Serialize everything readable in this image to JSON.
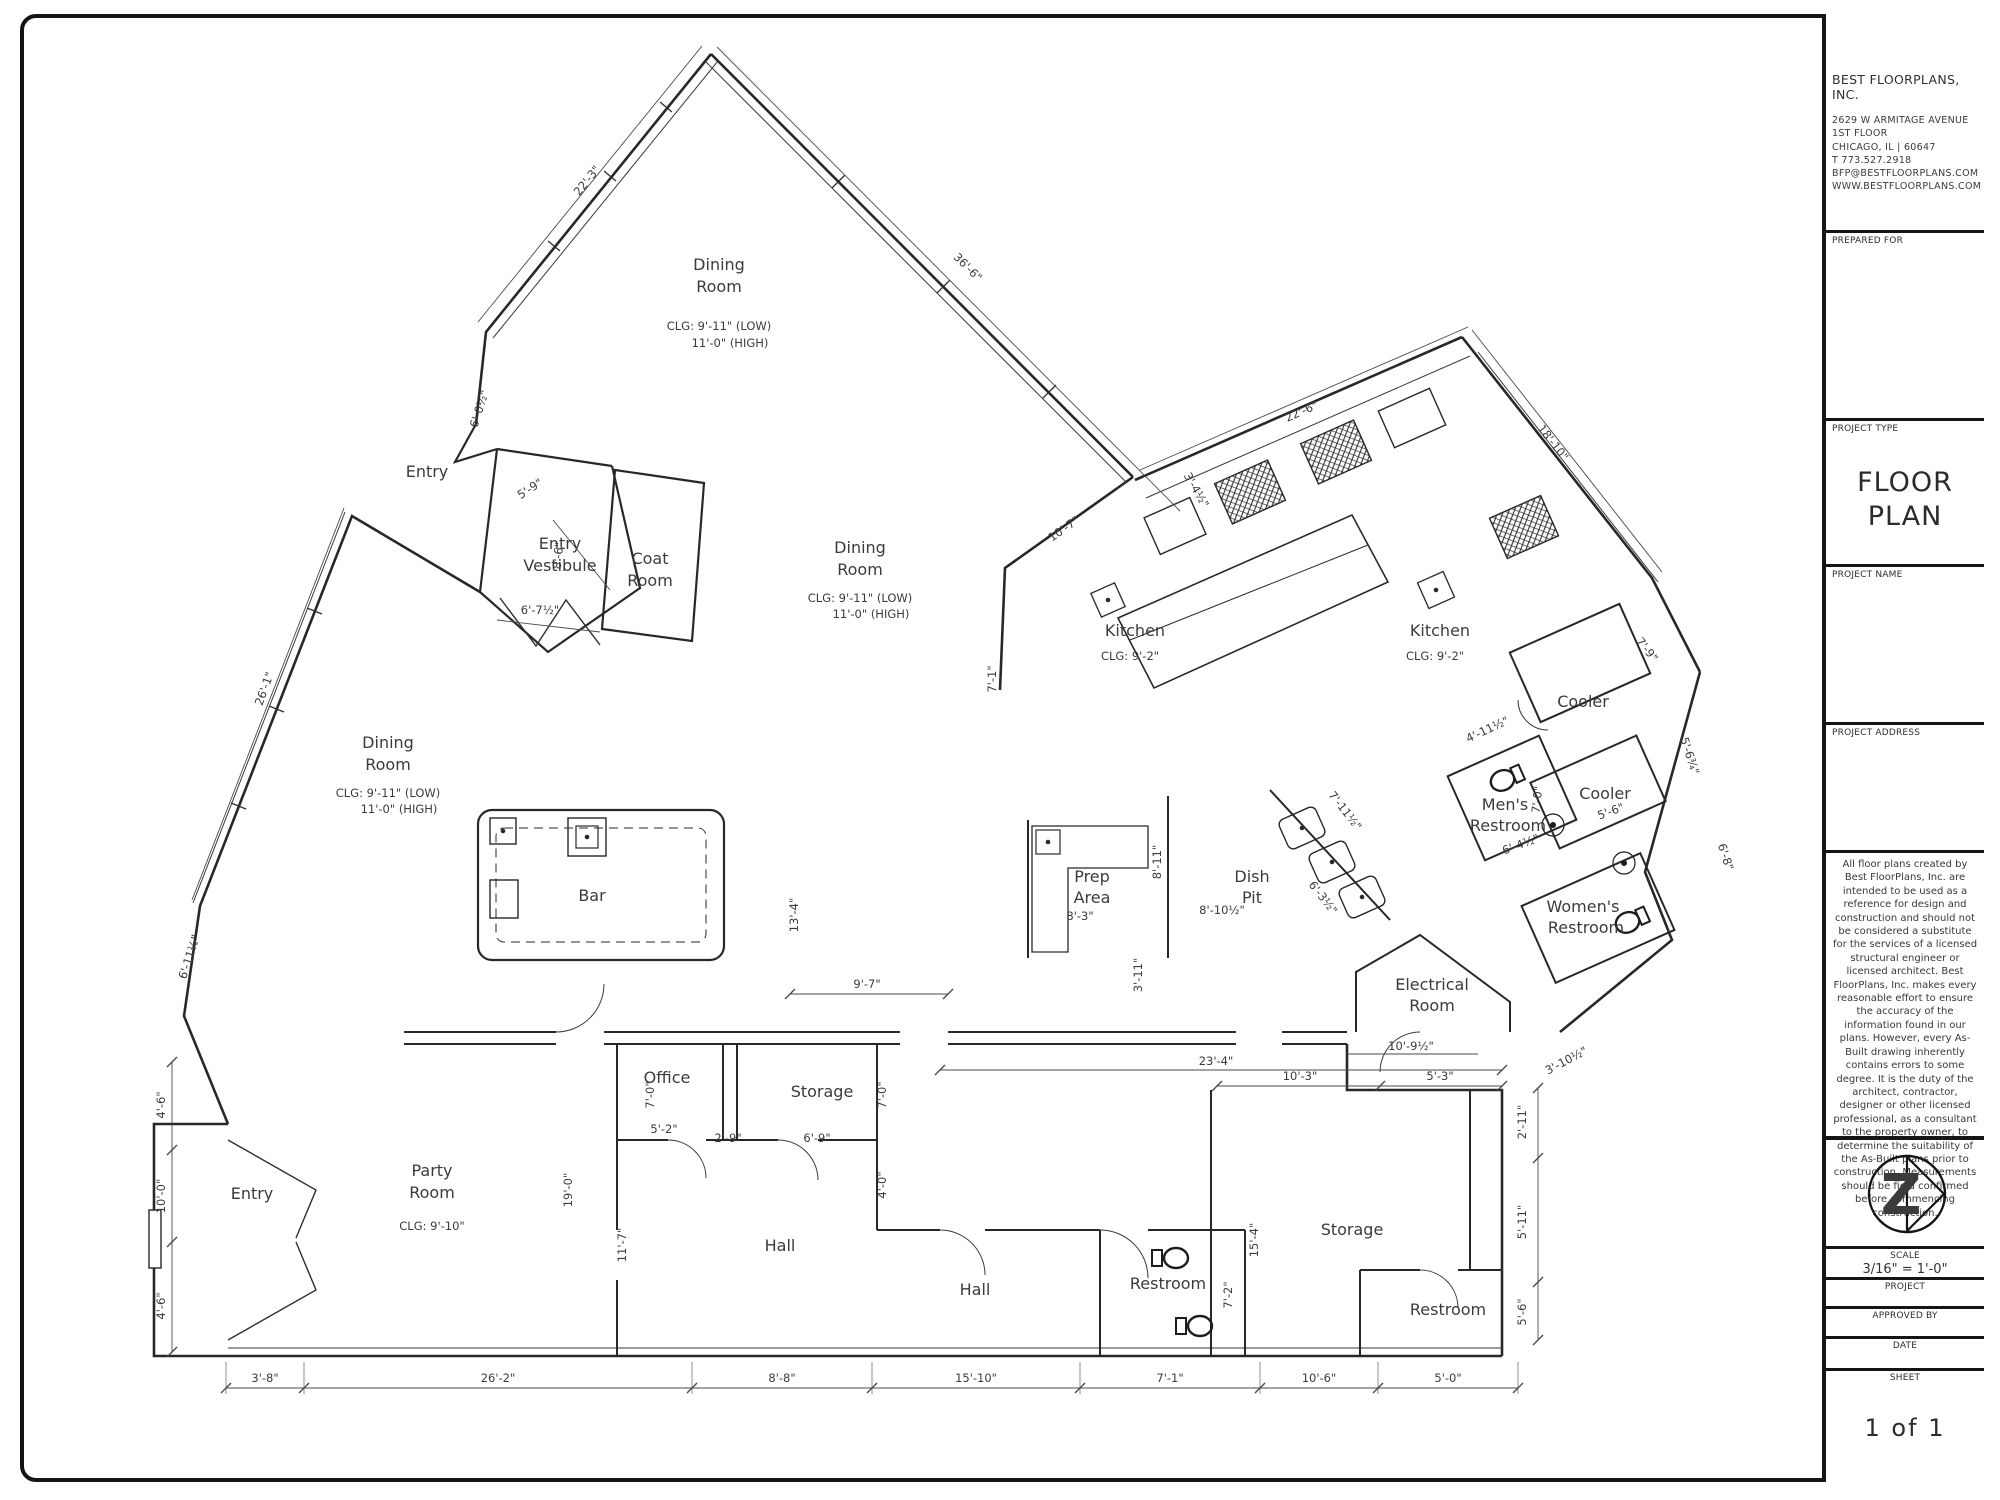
{
  "sheet": {
    "company": {
      "name": "BEST FLOORPLANS, INC.",
      "address1": "2629 W ARMITAGE AVENUE",
      "address2": "1ST FLOOR",
      "address3": "CHICAGO, IL | 60647",
      "phone": "T  773.527.2918",
      "email": "BFP@BESTFLOORPLANS.COM",
      "website": "WWW.BESTFLOORPLANS.COM"
    },
    "fields": {
      "prepared_for": "PREPARED FOR",
      "project_type_label": "PROJECT TYPE",
      "project_type_line1": "FLOOR",
      "project_type_line2": "PLAN",
      "project_name_label": "PROJECT NAME",
      "project_address_label": "PROJECT ADDRESS",
      "scale_label": "SCALE",
      "scale_value": "3/16\" = 1'-0\"",
      "project_label": "PROJECT",
      "approved_by_label": "APPROVED BY",
      "date_label": "DATE",
      "sheet_label": "SHEET",
      "sheet_value": "1 of 1"
    },
    "logo_letter": "Z",
    "disclaimer": "All floor plans created by Best FloorPlans, Inc. are intended to be used as a reference for design and construction and should not be considered a substitute for the services of a licensed structural engineer or licensed architect. Best FloorPlans, Inc. makes every reasonable effort to ensure the accuracy of the information found in our plans. However, every As-Built drawing inherently contains errors to some degree. It is the duty of the architect, contractor, designer or other licensed professional, as a consultant to the property owner, to determine the suitability of the As-Built plans prior to construction. Measurements should be field confirmed before commencing construction."
  },
  "rooms": [
    {
      "l1": "Dining",
      "l2": "Room",
      "c1": "CLG: 9'-11\" (LOW)",
      "c2": "11'-0\" (HIGH)"
    },
    {
      "l1": "Dining",
      "l2": "Room",
      "c1": "CLG: 9'-11\" (LOW)",
      "c2": "11'-0\" (HIGH)"
    },
    {
      "l1": "Dining",
      "l2": "Room",
      "c1": "CLG: 9'-11\" (LOW)",
      "c2": "11'-0\" (HIGH)"
    },
    {
      "l1": "Entry"
    },
    {
      "l1": "Entry",
      "l2": "Vestibule"
    },
    {
      "l1": "Coat",
      "l2": "Room"
    },
    {
      "l1": "Kitchen",
      "c1": "CLG: 9'-2\""
    },
    {
      "l1": "Kitchen",
      "c1": "CLG: 9'-2\""
    },
    {
      "l1": "Cooler"
    },
    {
      "l1": "Cooler"
    },
    {
      "l1": "Men's",
      "l2": "Restroom"
    },
    {
      "l1": "Women's",
      "l2": "Restroom"
    },
    {
      "l1": "Prep",
      "l2": "Area"
    },
    {
      "l1": "Dish",
      "l2": "Pit"
    },
    {
      "l1": "Electrical",
      "l2": "Room"
    },
    {
      "l1": "Bar"
    },
    {
      "l1": "Office"
    },
    {
      "l1": "Storage"
    },
    {
      "l1": "Hall"
    },
    {
      "l1": "Hall"
    },
    {
      "l1": "Restroom"
    },
    {
      "l1": "Storage"
    },
    {
      "l1": "Restroom"
    },
    {
      "l1": "Party",
      "l2": "Room",
      "c1": "CLG: 9'-10\""
    },
    {
      "l1": "Entry"
    }
  ],
  "dims": [
    "22'-3\"",
    "36'-6\"",
    "6'-0½\"",
    "5'-9\"",
    "8'-6\"",
    "6'-7½\"",
    "26'-1\"",
    "6'-11½\"",
    "4'-6\"",
    "10'-0\"",
    "4'-6\"",
    "22'-6\"",
    "3'-4½\"",
    "10'-7\"",
    "18'-10\"",
    "7'-9\"",
    "7'-1\"",
    "5'-6¾\"",
    "6'-8\"",
    "4'-11½\"",
    "7'-0\"",
    "6'-4½\"",
    "5'-6\"",
    "7'-11½\"",
    "6'-3½\"",
    "8'-11\"",
    "8'-3\"",
    "8'-10½\"",
    "3'-11\"",
    "9'-7\"",
    "13'-4\"",
    "23'-4\"",
    "10'-9½\"",
    "10'-3\"",
    "5'-3\"",
    "3'-10½\"",
    "2'-11\"",
    "5'-11\"",
    "5'-6\"",
    "15'-4\"",
    "7'-2\"",
    "7'-0\"",
    "5'-2\"",
    "2'-9\"",
    "6'-9\"",
    "7'-0\"",
    "4'-0\"",
    "11'-7\"",
    "19'-0\"",
    "3'-8\"",
    "26'-2\"",
    "8'-8\"",
    "15'-10\"",
    "7'-1\"",
    "10'-6\"",
    "5'-0\""
  ]
}
